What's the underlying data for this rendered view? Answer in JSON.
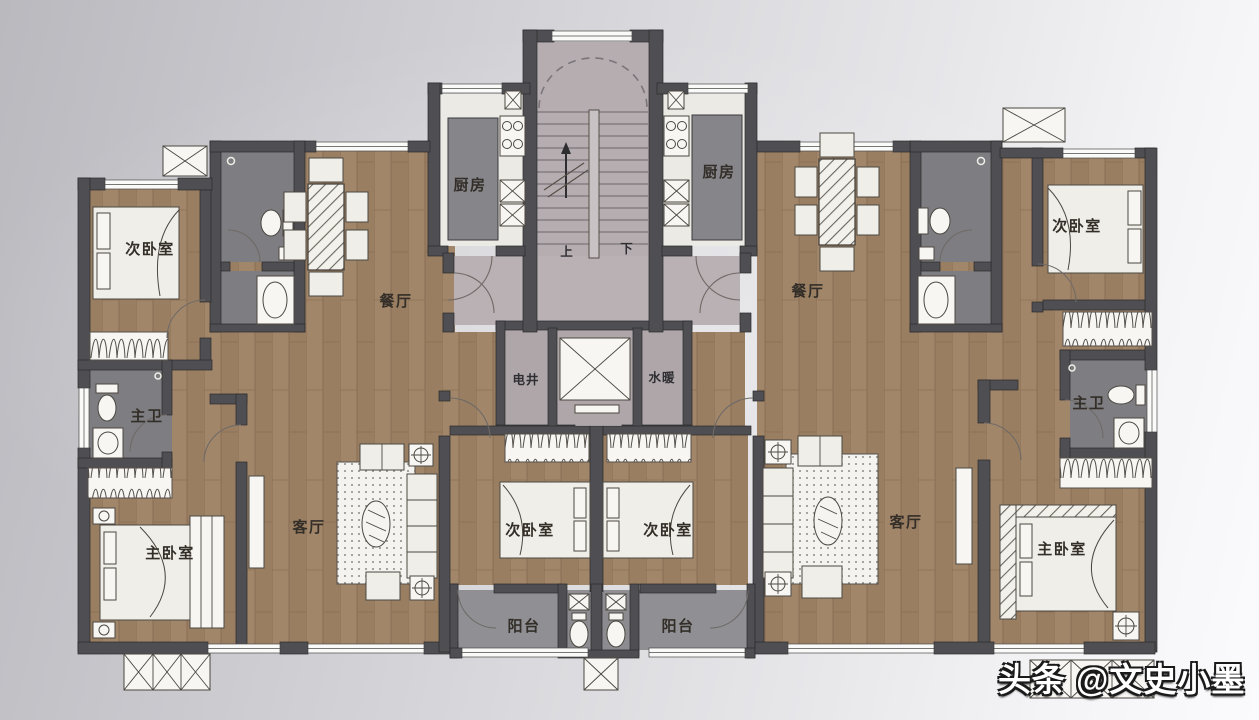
{
  "photo": {
    "watermark": "头条 @文史小墨"
  },
  "floor_plan": {
    "core": {
      "shaft_left": "电井",
      "shaft_right": "水暖",
      "stair_up": "上",
      "stair_down": "下"
    },
    "left_unit": {
      "kitchen": "厨房",
      "dining": "餐厅",
      "living": "客厅",
      "bedroom_top": "次卧室",
      "bedroom_center": "次卧室",
      "master_bedroom": "主卧室",
      "master_bath": "主卫",
      "balcony": "阳台"
    },
    "right_unit": {
      "kitchen": "厨房",
      "dining": "餐厅",
      "living": "客厅",
      "bedroom_top": "次卧室",
      "bedroom_center": "次卧室",
      "master_bedroom": "主卧室",
      "master_bath": "主卫",
      "balcony": "阳台"
    }
  }
}
